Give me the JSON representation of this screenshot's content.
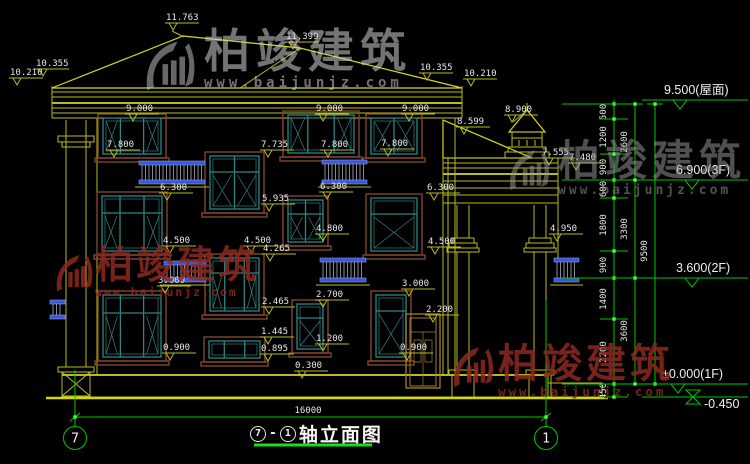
{
  "drawing": {
    "title": {
      "axis_from": "7",
      "separator": "-",
      "axis_to": "1",
      "label": "轴立面图"
    },
    "axis_bubbles": [
      {
        "label": "7"
      },
      {
        "label": "1"
      }
    ],
    "overall_width_dim": "16000"
  },
  "watermark": {
    "cn": "柏竣建筑",
    "url": "www.baijunjz.com"
  },
  "elevation_marks": [
    {
      "label": "9.500(屋面)",
      "y": 100
    },
    {
      "label": "6.900(3F)",
      "y": 180
    },
    {
      "label": "3.600(2F)",
      "y": 278
    },
    {
      "label": "±0.000(1F)",
      "y": 384
    },
    {
      "label": "-0.450",
      "y": 397
    }
  ],
  "dimension_chains": {
    "inner": [
      {
        "v": "500",
        "y": 112
      },
      {
        "v": "1200",
        "y": 137
      },
      {
        "v": "900",
        "y": 167
      },
      {
        "v": "600",
        "y": 189
      },
      {
        "v": "1800",
        "y": 225
      },
      {
        "v": "900",
        "y": 265
      },
      {
        "v": "1400",
        "y": 299
      },
      {
        "v": "2200",
        "y": 352
      },
      {
        "v": "450",
        "y": 391
      }
    ],
    "middle": [
      {
        "v": "2600",
        "y": 142
      },
      {
        "v": "3300",
        "y": 229
      },
      {
        "v": "3600",
        "y": 331
      }
    ],
    "outer": [
      {
        "v": "9500",
        "y": 251
      }
    ]
  },
  "facade_labels": [
    {
      "v": "11.763",
      "x": 166,
      "y": 20
    },
    {
      "v": "11.399",
      "x": 286,
      "y": 39
    },
    {
      "v": "10.355",
      "x": 36,
      "y": 66
    },
    {
      "v": "10.210",
      "x": 10,
      "y": 75
    },
    {
      "v": "10.355",
      "x": 420,
      "y": 70
    },
    {
      "v": "10.210",
      "x": 464,
      "y": 76
    },
    {
      "v": "9.000",
      "x": 126,
      "y": 111
    },
    {
      "v": "9.000",
      "x": 316,
      "y": 111
    },
    {
      "v": "9.000",
      "x": 402,
      "y": 111
    },
    {
      "v": "8.900",
      "x": 505,
      "y": 112
    },
    {
      "v": "8.599",
      "x": 457,
      "y": 124
    },
    {
      "v": "7.800",
      "x": 107,
      "y": 147
    },
    {
      "v": "7.735",
      "x": 261,
      "y": 147
    },
    {
      "v": "7.800",
      "x": 321,
      "y": 147
    },
    {
      "v": "7.800",
      "x": 381,
      "y": 146
    },
    {
      "v": "7.555",
      "x": 542,
      "y": 155
    },
    {
      "v": "7.480",
      "x": 569,
      "y": 160
    },
    {
      "v": "6.300",
      "x": 160,
      "y": 190
    },
    {
      "v": "6.300",
      "x": 320,
      "y": 189
    },
    {
      "v": "6.300",
      "x": 427,
      "y": 190
    },
    {
      "v": "5.935",
      "x": 262,
      "y": 201
    },
    {
      "v": "4.800",
      "x": 316,
      "y": 231
    },
    {
      "v": "4.500",
      "x": 163,
      "y": 243
    },
    {
      "v": "4.500",
      "x": 244,
      "y": 243
    },
    {
      "v": "4.500",
      "x": 428,
      "y": 244
    },
    {
      "v": "4.950",
      "x": 550,
      "y": 231
    },
    {
      "v": "4.265",
      "x": 263,
      "y": 251
    },
    {
      "v": "3.000",
      "x": 158,
      "y": 283
    },
    {
      "v": "3.000",
      "x": 402,
      "y": 286
    },
    {
      "v": "2.700",
      "x": 316,
      "y": 297
    },
    {
      "v": "2.465",
      "x": 262,
      "y": 304
    },
    {
      "v": "2.200",
      "x": 426,
      "y": 312
    },
    {
      "v": "1.445",
      "x": 261,
      "y": 334
    },
    {
      "v": "1.200",
      "x": 316,
      "y": 341
    },
    {
      "v": "0.900",
      "x": 163,
      "y": 350
    },
    {
      "v": "0.900",
      "x": 400,
      "y": 350
    },
    {
      "v": "0.895",
      "x": 261,
      "y": 351
    },
    {
      "v": "0.300",
      "x": 295,
      "y": 368
    },
    {
      "v": "16000",
      "x": 308,
      "y": 413,
      "a": "m",
      "nm": 1
    }
  ],
  "colors": {
    "background": "#000000",
    "cad_yellow": "#b9ba1f",
    "cad_green": "#00c800",
    "window_frame_teal": "#2f8585",
    "window_surround_brown": "#8a4a30",
    "railing_blue": "#3d58cf",
    "text": "#e8e8e8",
    "watermark_red": "#8c2c24",
    "watermark_gray": "#bdbdbd"
  }
}
